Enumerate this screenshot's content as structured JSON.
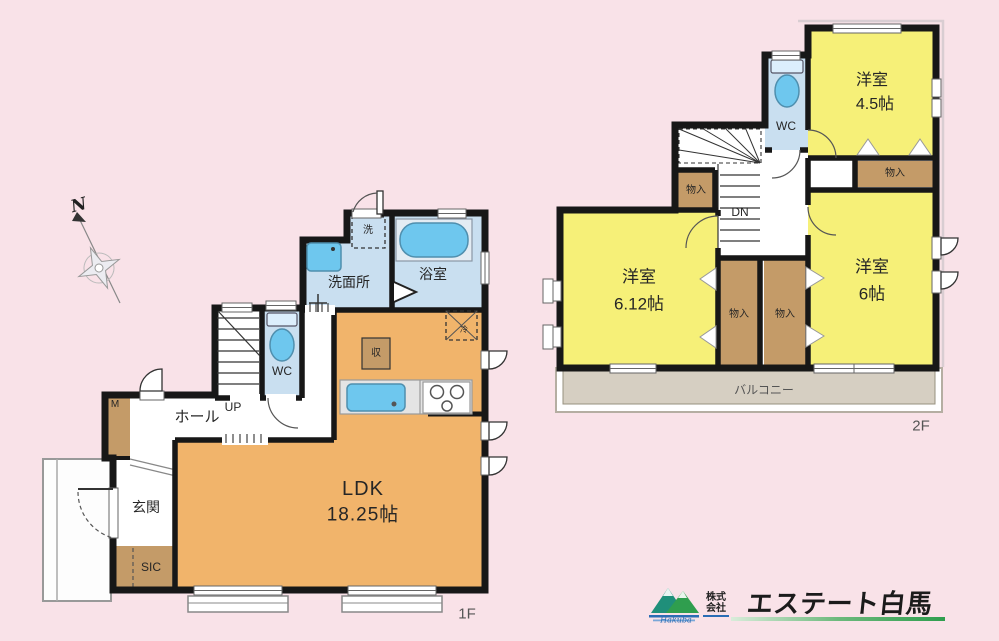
{
  "floor1": {
    "label": "1F",
    "ldk_name": "LDK",
    "ldk_size": "18.25帖",
    "washroom": "洗面所",
    "bath": "浴室",
    "wc": "WC",
    "hall": "ホール",
    "entrance": "玄関",
    "sic": "SIC",
    "m_closet": "M",
    "storage": "収",
    "washer": "洗",
    "fridge": "冷",
    "stairs_up": "UP"
  },
  "floor2": {
    "label": "2F",
    "room45_name": "洋室",
    "room45_size": "4.5帖",
    "room612_name": "洋室",
    "room612_size": "6.12帖",
    "room6_name": "洋室",
    "room6_size": "6帖",
    "wc": "WC",
    "stairs_down": "DN",
    "closet_label": "物入",
    "balcony": "バルコニー"
  },
  "compass": {
    "north": "N"
  },
  "logo": {
    "company_type_top": "株式",
    "company_type_bottom": "会社",
    "company_name": "エステート白馬",
    "mountain_script": "Hakuba"
  },
  "colors": {
    "background": "#f9e2e8",
    "room_orange": "#f1b46b",
    "room_yellow": "#f6f078",
    "wet_area_blue": "#c9dff0",
    "fixture_blue": "#6ec7ee",
    "closet_tan": "#c49b68",
    "balcony_gray": "#d6cfc2",
    "wall_black": "#171717",
    "logo_green": "#2f9e4e",
    "logo_blue": "#2a6db5"
  }
}
